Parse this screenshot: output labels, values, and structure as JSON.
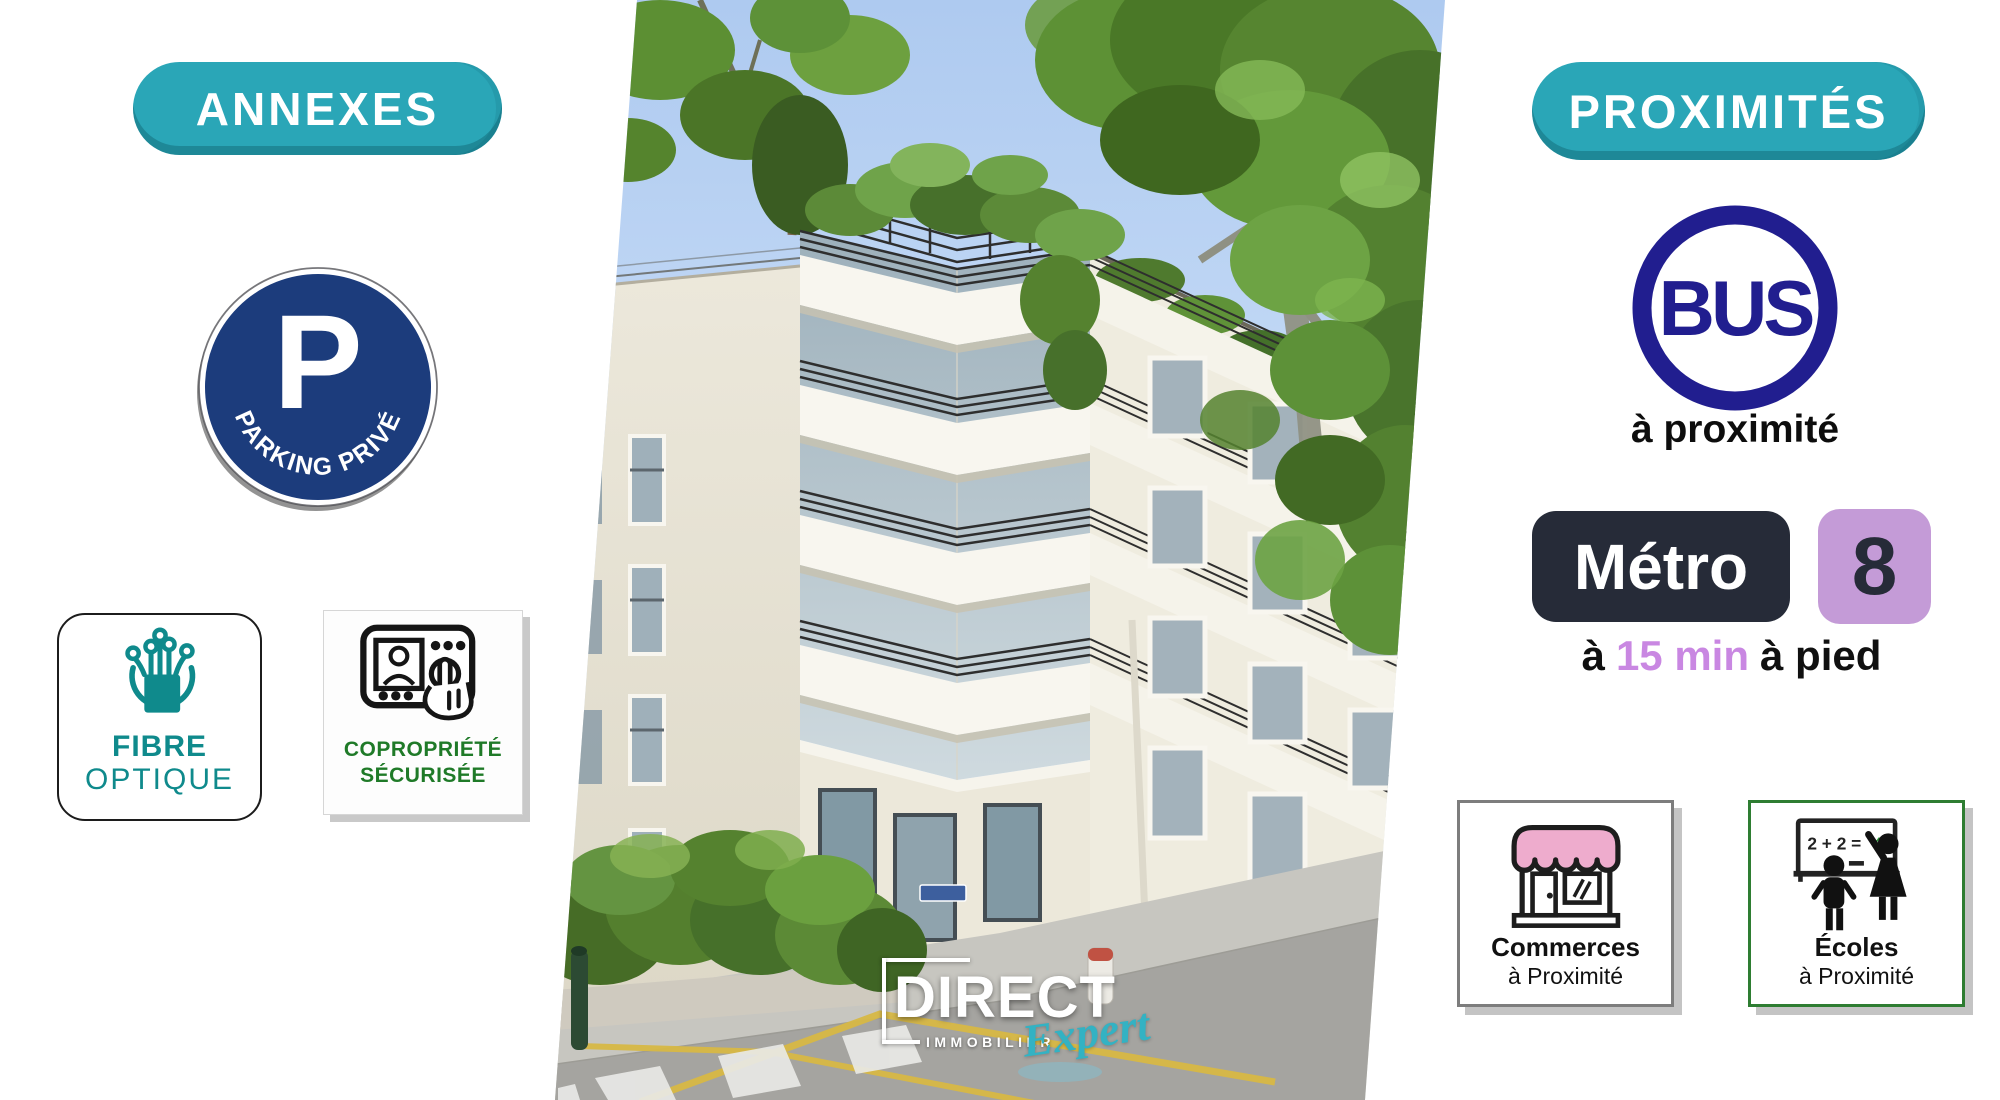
{
  "annexes": {
    "label": "ANNEXES"
  },
  "proximites": {
    "label": "PROXIMITÉS"
  },
  "parking": {
    "letter": "P",
    "curved_label": "PARKING PRIVÉ"
  },
  "fibre": {
    "line1": "FIBRE",
    "line2": "OPTIQUE"
  },
  "copropriete": {
    "line1": "COPROPRIÉTÉ",
    "line2": "SÉCURISÉE"
  },
  "bus": {
    "label": "BUS",
    "caption": "à proximité"
  },
  "metro": {
    "badge": "Métro",
    "line_number": "8",
    "walk_prefix": "à",
    "walk_time": "15 min",
    "walk_suffix": "à pied"
  },
  "commerces": {
    "line1": "Commerces",
    "line2": "à Proximité"
  },
  "ecoles": {
    "equation_prefix": "2 + 2 =",
    "equation_answer": "4",
    "line1": "Écoles",
    "line2": "à Proximité"
  },
  "logo": {
    "name": "DIRECT",
    "subtitle": "IMMOBILIER",
    "tagline": "Expert"
  },
  "colors": {
    "teal": "#2aa6b7",
    "teal_dark": "#1b8496",
    "parking_navy": "#1c3c7c",
    "bus_navy": "#211e8f",
    "metro_dark": "#262b38",
    "metro_purple": "#c49bd7",
    "walk_purple": "#c987e2",
    "school_green": "#2e7d32",
    "copro_green": "#1f7a28",
    "fibre_teal": "#0f8a8c",
    "awning_pink": "#eeaccd",
    "logo_teal": "#33b2c3"
  }
}
